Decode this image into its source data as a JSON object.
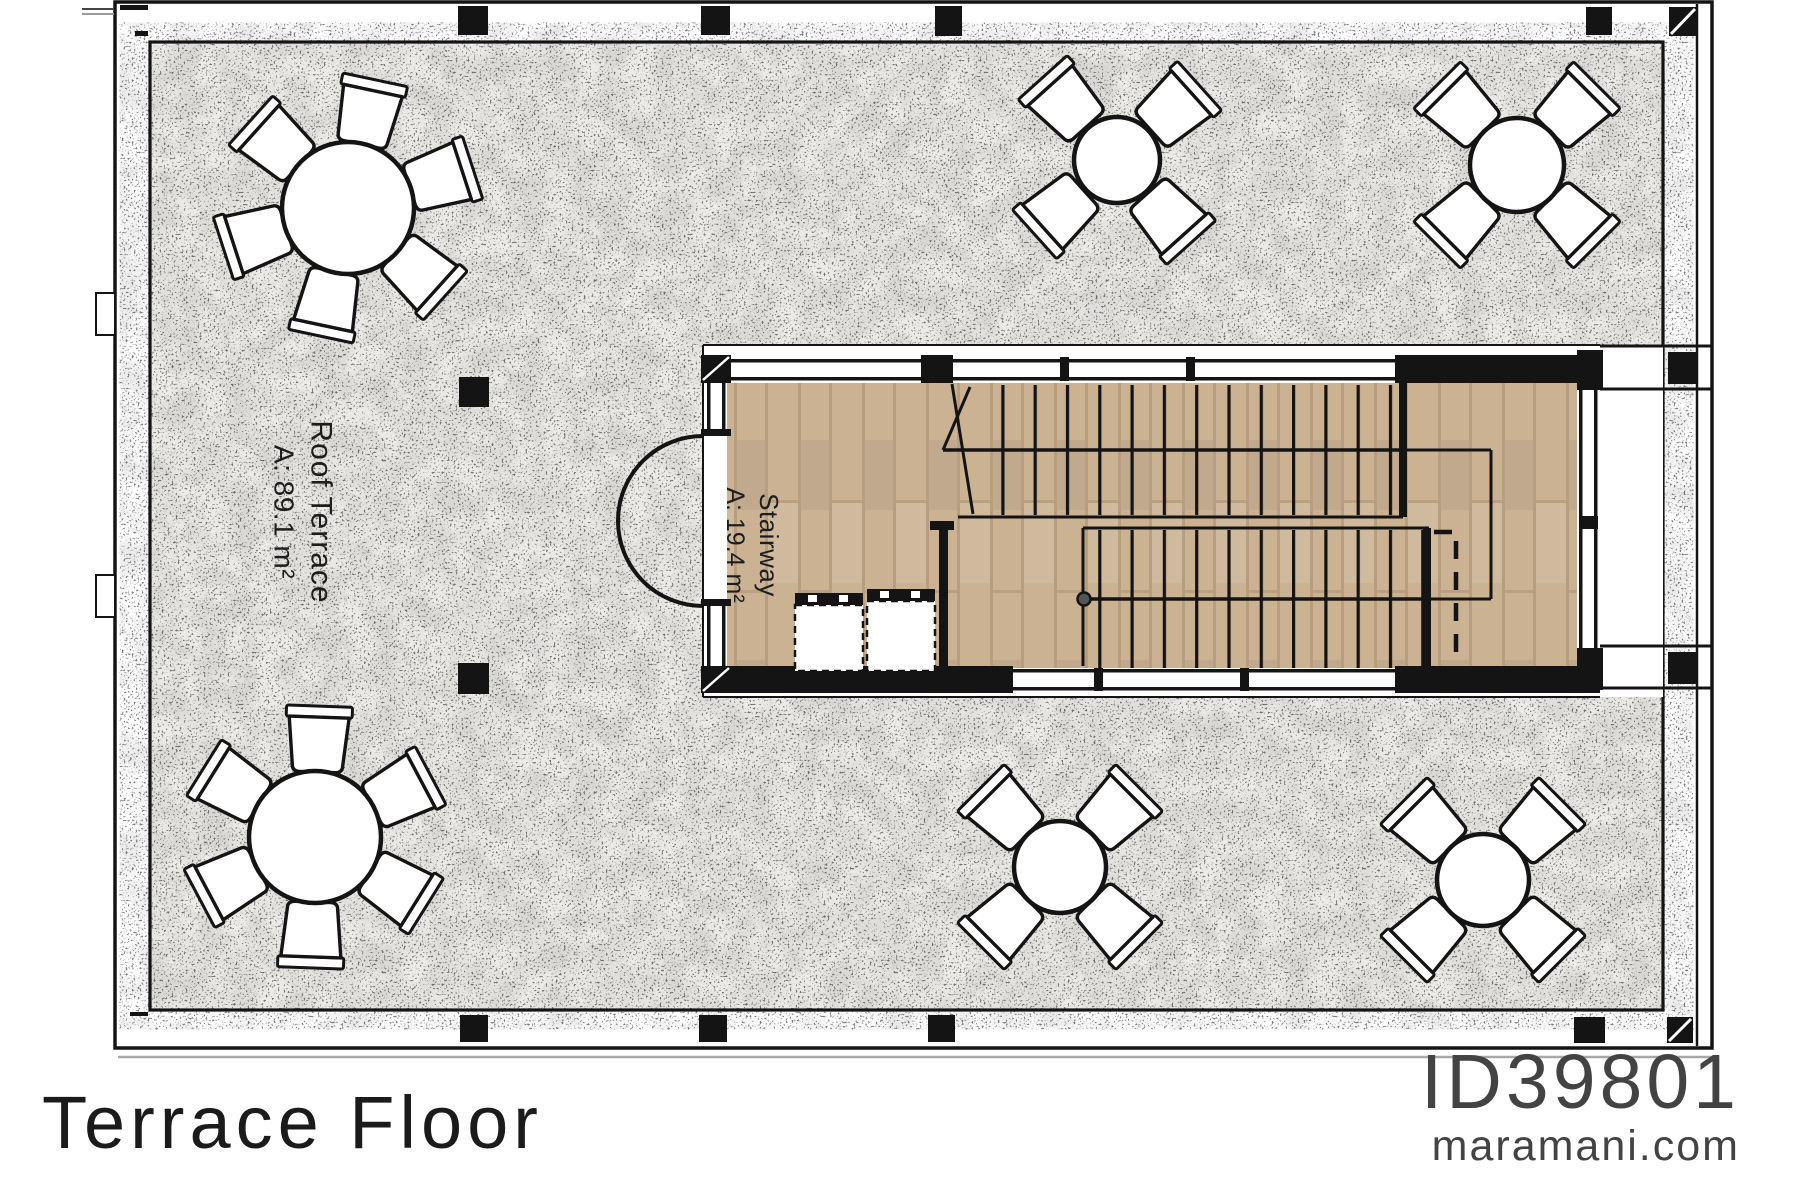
{
  "plan": {
    "title": "Terrace Floor",
    "plan_id": "ID39801",
    "website": "maramani.com",
    "rooms": [
      {
        "name": "Roof Terrace",
        "area": "A: 89.1 m²"
      },
      {
        "name": "Stairway",
        "area": "A: 19.4 m²"
      }
    ],
    "furniture": {
      "round_tables_with_6_chairs": 2,
      "round_tables_with_4_chairs": 4
    },
    "colors": {
      "wall_line": "#141414",
      "wood_floor": "#cab293",
      "terrace_fill": "#ecebe8",
      "footer_text": "#434343"
    }
  }
}
